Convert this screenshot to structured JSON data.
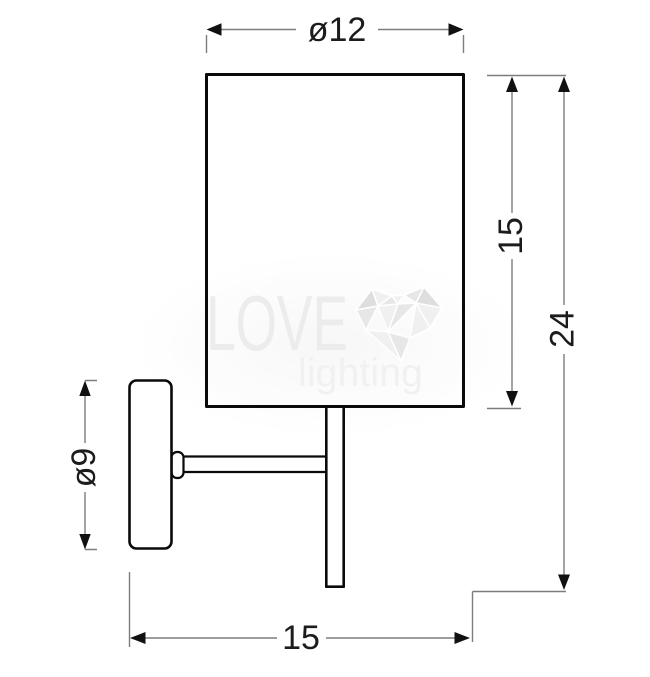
{
  "colors": {
    "background": "#ffffff",
    "object-line": "#0a0a0a",
    "dimension-line": "#7d7d7d",
    "arrowhead": "#111111",
    "dimension-text": "#1c1c1c",
    "watermark-text": "#ececec",
    "watermark-text-light": "#f1f1f1",
    "watermark-heart-light": "#f0f0f0",
    "watermark-heart-mid": "#e7e7e7",
    "watermark-heart-dark": "#dedede"
  },
  "dimension_labels": {
    "shade_diameter": "ø12",
    "shade_height": "15",
    "total_height": "24",
    "plate_diameter": "ø9",
    "total_width": "15"
  },
  "watermark": {
    "brand_word": "LOVE",
    "brand_subword": "lighting"
  }
}
